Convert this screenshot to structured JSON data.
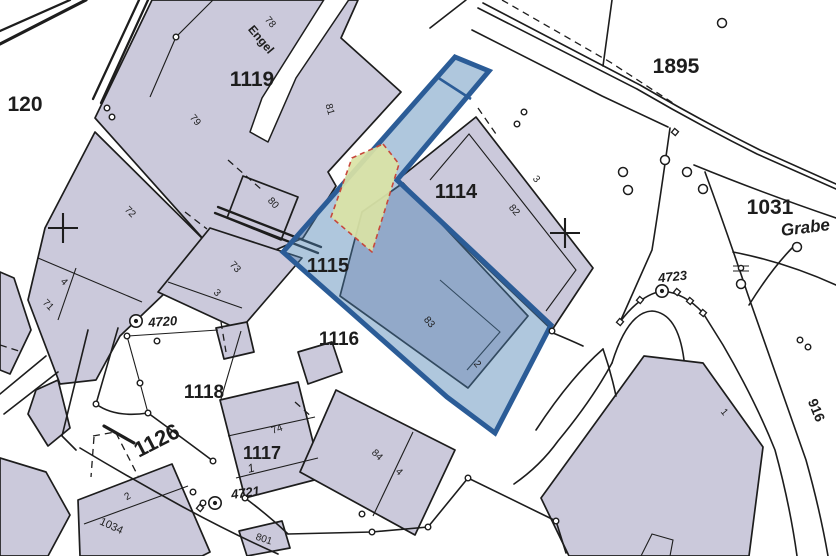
{
  "map": {
    "colors": {
      "paper": "#ffffff",
      "parcel_fill": "#cbc9db",
      "ink": "#1d1d1d",
      "overlay_fill": "#4e82b4",
      "overlay_stroke": "#2b5c97",
      "sub_fill": "#dae3a5",
      "sub_stroke": "#c7483c",
      "highlight_label": "#1e3f6b"
    },
    "labels": [
      {
        "text": "1119",
        "x": 252,
        "y": 86,
        "size": 21,
        "weight": 700
      },
      {
        "text": "120",
        "x": 25,
        "y": 111,
        "size": 21,
        "weight": 700
      },
      {
        "text": "1895",
        "x": 676,
        "y": 73,
        "size": 21,
        "weight": 700
      },
      {
        "text": "1031",
        "x": 770,
        "y": 214,
        "size": 21,
        "weight": 700
      },
      {
        "text": "1114",
        "x": 456,
        "y": 198,
        "size": 20,
        "weight": 700
      },
      {
        "text": "1115",
        "x": 328,
        "y": 272,
        "size": 20,
        "weight": 700,
        "color": "highlight"
      },
      {
        "text": "1116",
        "x": 339,
        "y": 345,
        "size": 19,
        "weight": 700
      },
      {
        "text": "1118",
        "x": 204,
        "y": 398,
        "size": 19,
        "weight": 700
      },
      {
        "text": "1117",
        "x": 262,
        "y": 459,
        "size": 18,
        "weight": 700
      },
      {
        "text": "1126",
        "x": 160,
        "y": 447,
        "rot": -27,
        "size": 22,
        "weight": 700
      },
      {
        "text": "Grabe",
        "x": 806,
        "y": 233,
        "rot": -7,
        "size": 17,
        "weight": 600,
        "italic": true
      },
      {
        "text": "916",
        "x": 812,
        "y": 412,
        "rot": 68,
        "size": 14,
        "weight": 700
      },
      {
        "text": "4720",
        "x": 163,
        "y": 326,
        "rot": -4,
        "size": 13,
        "weight": 700,
        "italic": true
      },
      {
        "text": "4721",
        "x": 246,
        "y": 497,
        "rot": -8,
        "size": 13,
        "weight": 700,
        "italic": true
      },
      {
        "text": "4723",
        "x": 673,
        "y": 281,
        "rot": -6,
        "size": 13,
        "weight": 700,
        "italic": true
      },
      {
        "text": "78",
        "x": 268,
        "y": 24,
        "rot": 50,
        "size": 10
      },
      {
        "text": "Engel",
        "x": 258,
        "y": 42,
        "rot": 50,
        "size": 12,
        "weight": 600
      },
      {
        "text": "79",
        "x": 193,
        "y": 122,
        "rot": 50,
        "size": 10
      },
      {
        "text": "81",
        "x": 327,
        "y": 110,
        "rot": 75,
        "size": 10
      },
      {
        "text": "80",
        "x": 271,
        "y": 205,
        "rot": 48,
        "size": 10
      },
      {
        "text": "72",
        "x": 128,
        "y": 214,
        "rot": 45,
        "size": 10
      },
      {
        "text": "73",
        "x": 233,
        "y": 269,
        "rot": 48,
        "size": 10
      },
      {
        "text": "3",
        "x": 215,
        "y": 295,
        "rot": 45,
        "size": 10
      },
      {
        "text": "4",
        "x": 62,
        "y": 284,
        "rot": 45,
        "size": 10
      },
      {
        "text": "71",
        "x": 46,
        "y": 307,
        "rot": 45,
        "size": 10
      },
      {
        "text": "82",
        "x": 512,
        "y": 212,
        "rot": 50,
        "size": 10
      },
      {
        "text": "3",
        "x": 534,
        "y": 181,
        "rot": 50,
        "size": 10
      },
      {
        "text": "83",
        "x": 427,
        "y": 324,
        "rot": 50,
        "size": 10
      },
      {
        "text": "2",
        "x": 475,
        "y": 366,
        "rot": 50,
        "size": 10
      },
      {
        "text": "84",
        "x": 375,
        "y": 457,
        "rot": 45,
        "size": 10
      },
      {
        "text": "4",
        "x": 397,
        "y": 474,
        "rot": 45,
        "size": 10
      },
      {
        "text": "74",
        "x": 278,
        "y": 432,
        "rot": -20,
        "size": 10
      },
      {
        "text": "1",
        "x": 252,
        "y": 472,
        "rot": -15,
        "size": 12,
        "italic": true
      },
      {
        "text": "2",
        "x": 129,
        "y": 499,
        "rot": -30,
        "size": 10
      },
      {
        "text": "1034",
        "x": 110,
        "y": 529,
        "rot": 25,
        "size": 11
      },
      {
        "text": "801",
        "x": 263,
        "y": 542,
        "rot": 18,
        "size": 10
      },
      {
        "text": "1",
        "x": 722,
        "y": 414,
        "rot": 50,
        "size": 10
      }
    ],
    "symbols": {
      "benchmarks": [
        [
          136,
          321
        ],
        [
          662,
          291
        ],
        [
          215,
          503
        ]
      ],
      "crosses": [
        [
          63,
          228
        ],
        [
          565,
          233
        ]
      ],
      "trees": [
        [
          623,
          172
        ],
        [
          628,
          190
        ],
        [
          665,
          160
        ],
        [
          687,
          172
        ],
        [
          703,
          189
        ],
        [
          741,
          284
        ],
        [
          722,
          23
        ],
        [
          797,
          247
        ]
      ],
      "points": [
        [
          176,
          37
        ],
        [
          107,
          108
        ],
        [
          112,
          117
        ],
        [
          524,
          112
        ],
        [
          517,
          124
        ],
        [
          552,
          331
        ],
        [
          96,
          404
        ],
        [
          140,
          383
        ],
        [
          127,
          336
        ],
        [
          157,
          341
        ],
        [
          148,
          413
        ],
        [
          213,
          461
        ],
        [
          245,
          498
        ],
        [
          362,
          514
        ],
        [
          372,
          532
        ],
        [
          428,
          527
        ],
        [
          468,
          478
        ],
        [
          556,
          521
        ],
        [
          193,
          492
        ],
        [
          203,
          503
        ],
        [
          800,
          340
        ],
        [
          808,
          347
        ]
      ],
      "squares": [
        [
          620,
          322
        ],
        [
          640,
          300
        ],
        [
          677,
          292
        ],
        [
          690,
          301
        ],
        [
          703,
          313
        ],
        [
          675,
          132
        ],
        [
          200,
          508
        ]
      ],
      "utility": [
        [
          741,
          268
        ]
      ]
    }
  }
}
